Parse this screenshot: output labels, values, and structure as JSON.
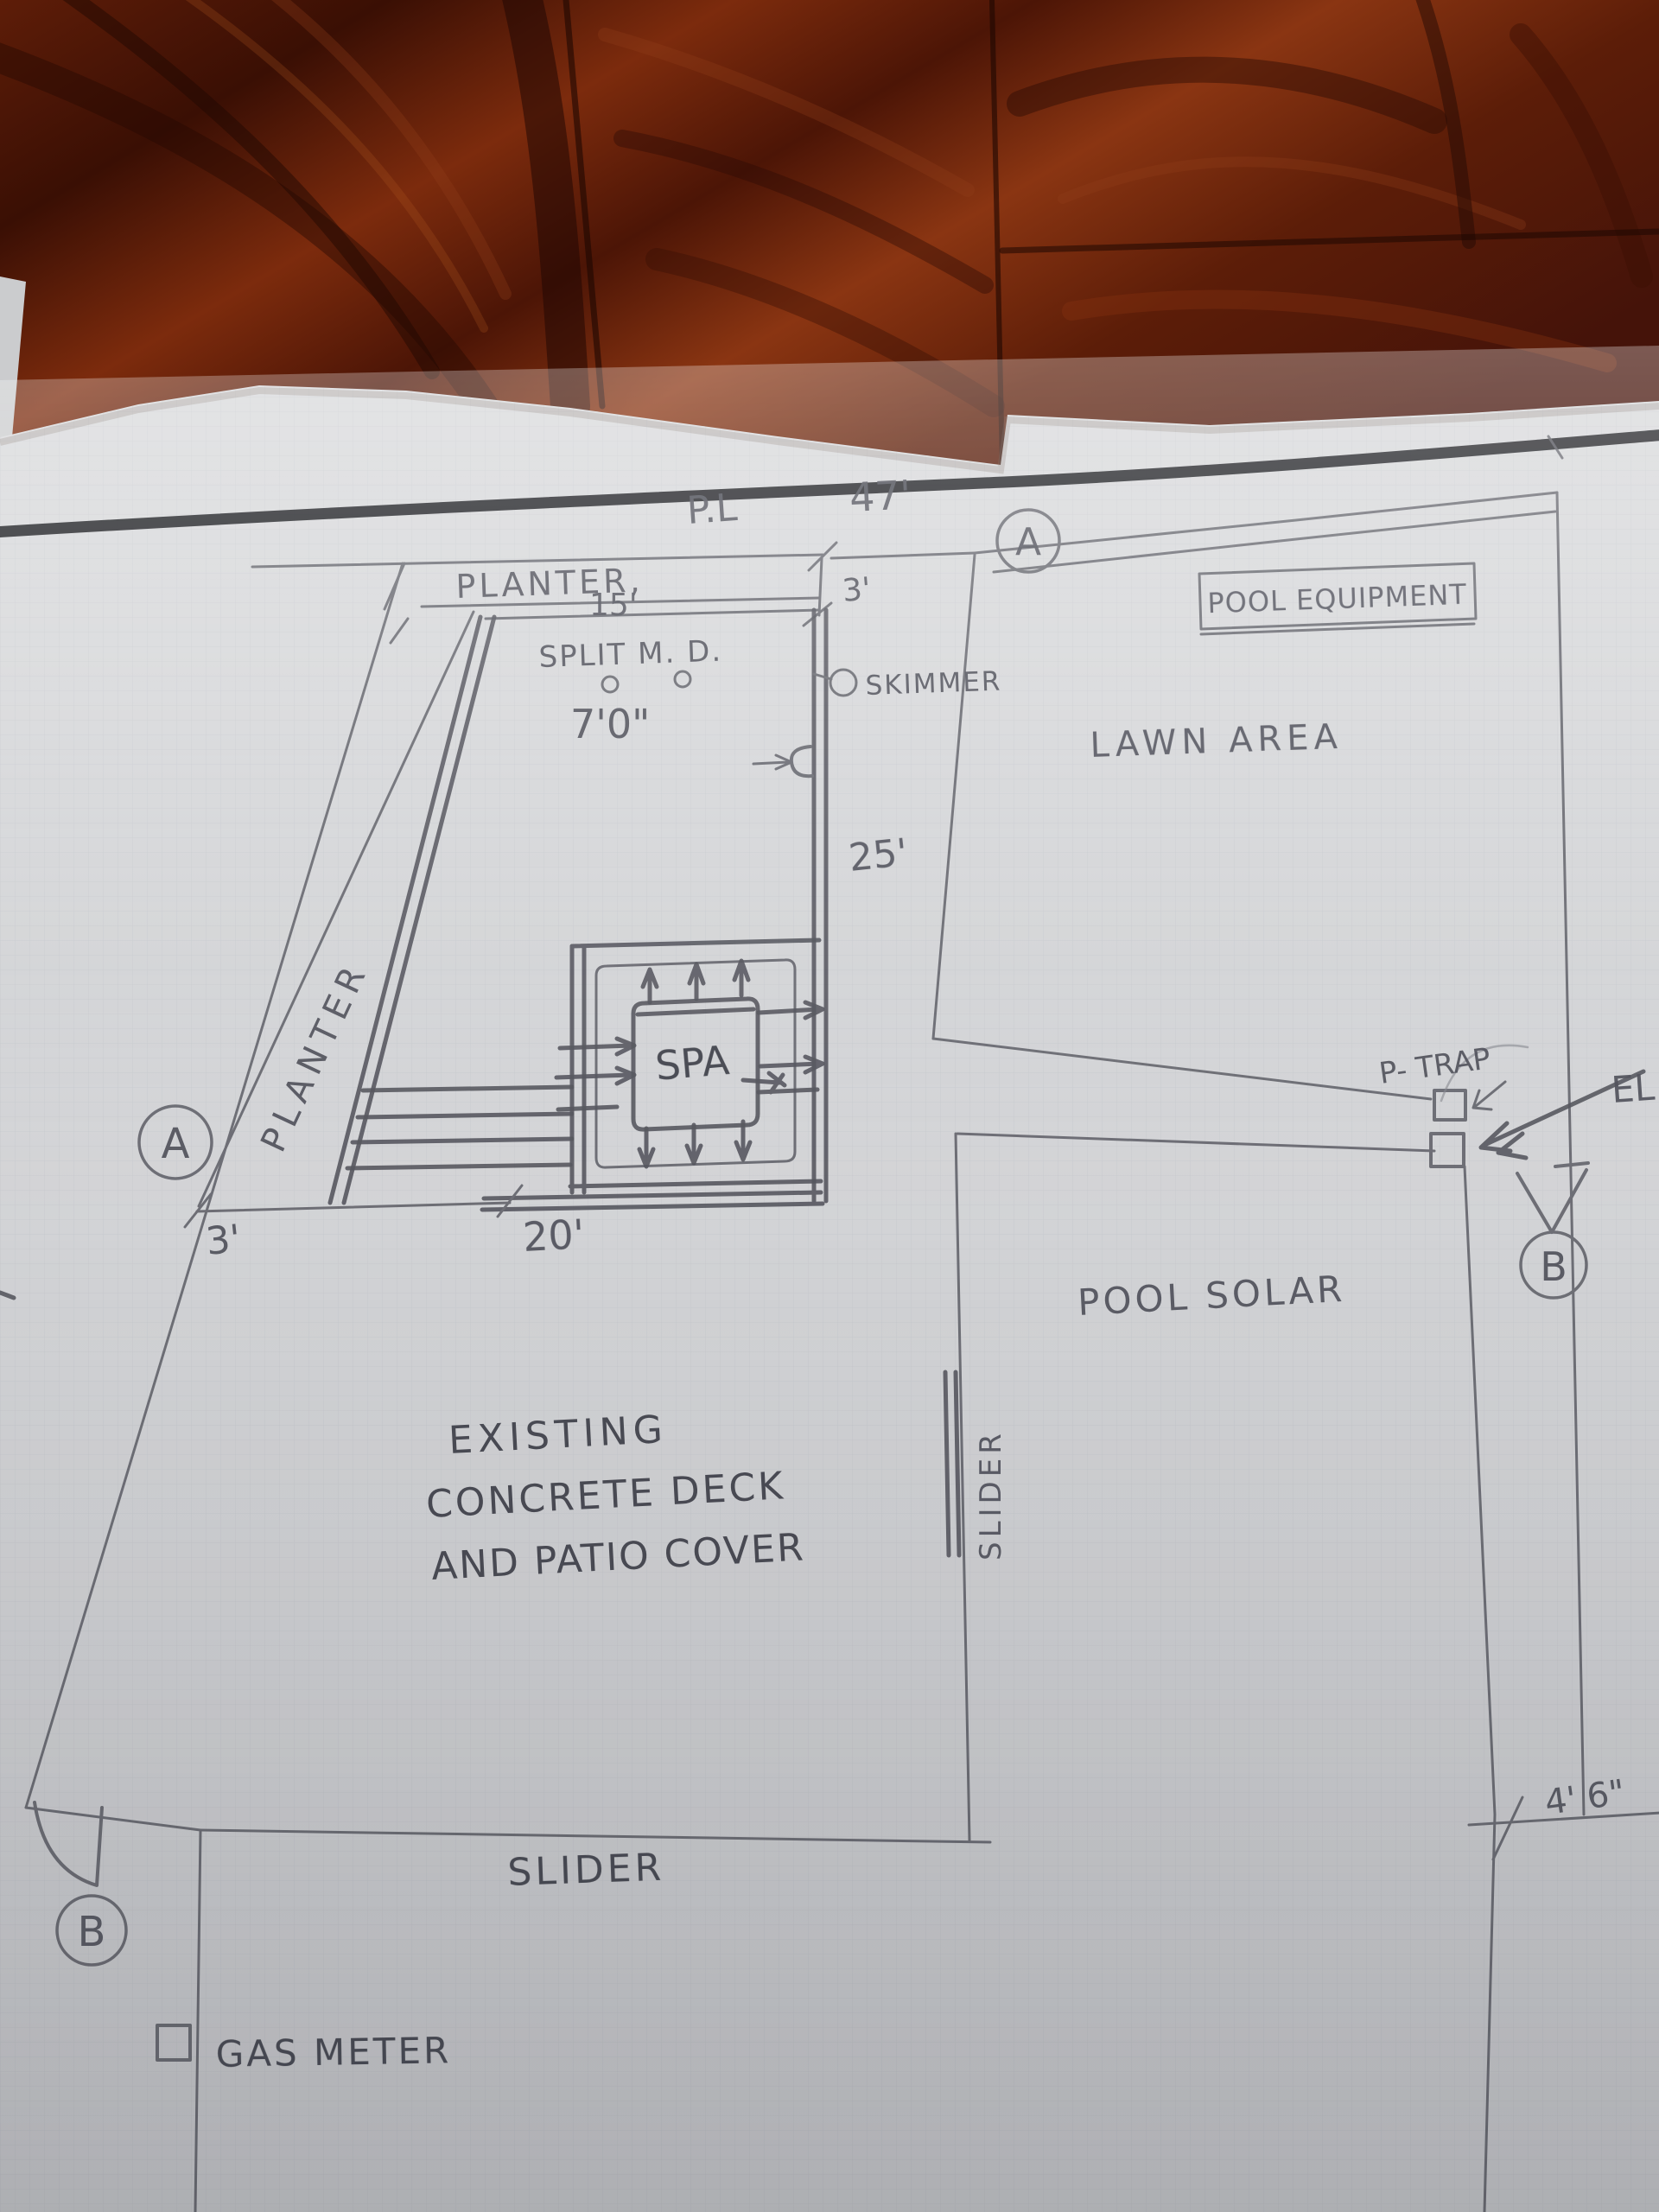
{
  "colors": {
    "wood_dark": "#2e0d04",
    "wood_mid": "#7a2a0e",
    "wood_light": "#a54d1f",
    "paper": "#d8d9db",
    "grid_line": "#c2c6cc",
    "pencil": "#5a5b63",
    "pencil_dark": "#3d3e46",
    "ink_black": "#15161a"
  },
  "plan": {
    "property_line_label": "P.L",
    "dim_47": "47'",
    "section_a_top": "A",
    "planter_top_label": "PLANTER,",
    "dim_15": "15'",
    "dim_3_top": "3'",
    "split_md_label": "SPLIT M. D.",
    "dim_7_0": "7'0\"",
    "skimmer_label": "SKIMMER",
    "pool_equipment_label": "POOL EQUIPMENT",
    "lawn_area_label": "LAWN AREA",
    "dim_25": "25'",
    "spa_label": "SPA",
    "planter_left_label": "PLANTER",
    "section_a_left": "A",
    "dim_3_left": "3'",
    "dim_20": "20'",
    "p_trap_label": "P- TRAP",
    "electrical_label": "EL",
    "section_b_right": "B",
    "pool_solar_label": "POOL SOLAR",
    "deck_note_line1": "EXISTING",
    "deck_note_line2": "CONCRETE DECK",
    "deck_note_line3": "AND PATIO COVER",
    "slider_side_label": "SLIDER",
    "slider_bottom_label": "SLIDER",
    "section_b_bottom": "B",
    "gas_meter_label": "GAS METER",
    "dim_4_6": "4' 6\""
  }
}
